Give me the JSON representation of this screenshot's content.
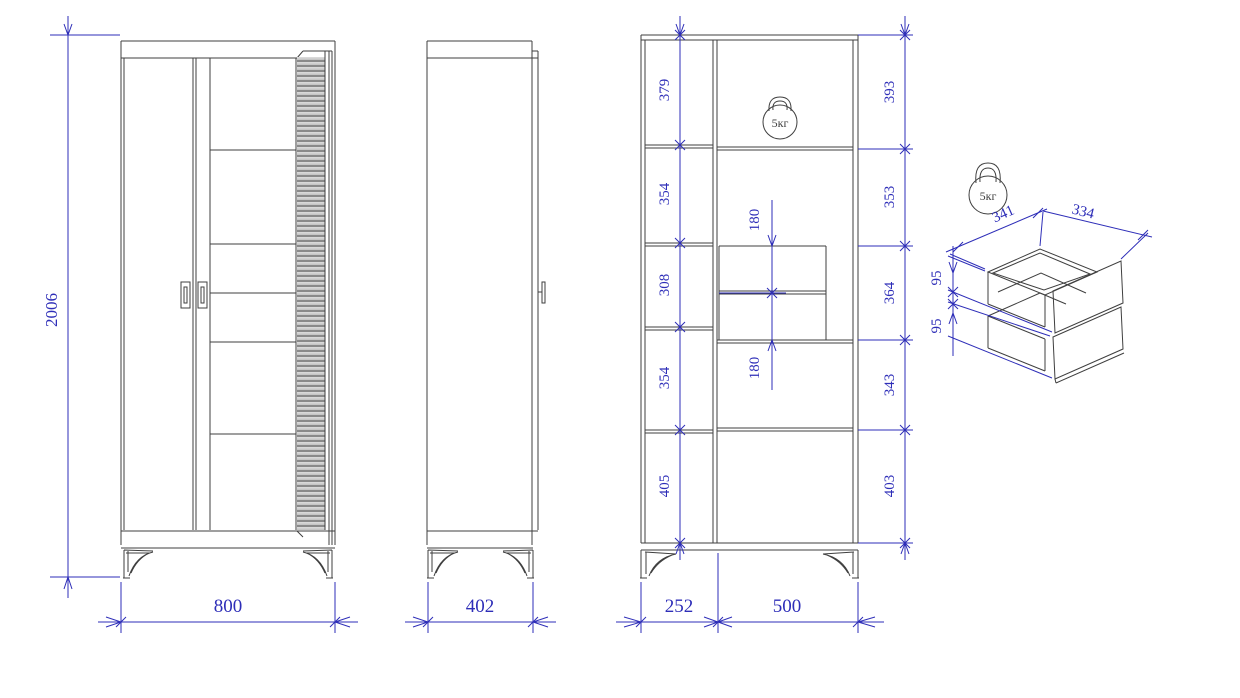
{
  "drawing": {
    "title": "wardrobe-dimension-drawing",
    "colors": {
      "dimension_accent": "#2e2eb8",
      "outline": "#3f3f3f",
      "background": "#ffffff"
    },
    "front_view": {
      "height": "2006",
      "width": "800"
    },
    "side_view": {
      "width": "402"
    },
    "internal_view": {
      "left_chain": [
        "379",
        "354",
        "308",
        "354",
        "405"
      ],
      "right_chain": [
        "393",
        "353",
        "364",
        "343",
        "403"
      ],
      "drawer_chain": [
        "180",
        "180"
      ],
      "bottom": [
        "252",
        "500"
      ],
      "load_badge": "5кг"
    },
    "drawer_detail": {
      "depth": "341",
      "width": "334",
      "heights": [
        "95",
        "95"
      ],
      "load_badge": "5кг"
    }
  }
}
